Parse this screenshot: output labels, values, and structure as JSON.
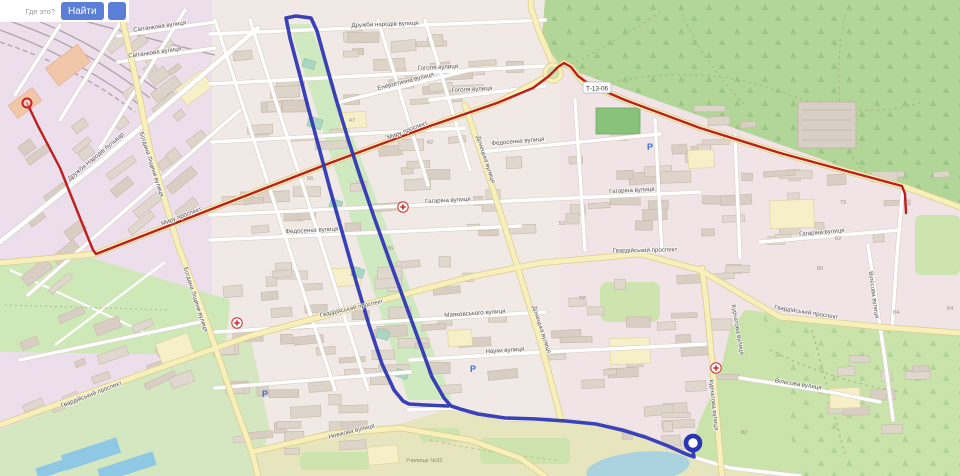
{
  "ui": {
    "search_placeholder": "Где это?",
    "find_label": "Найти",
    "accent_color": "#5b7ed7"
  },
  "map": {
    "shield_label": "Т-13-06",
    "colors": {
      "route_red": "#bc1f1f",
      "route_blue": "#2b34b3",
      "forest": "#b2d698",
      "water": "#aad3df",
      "road_yellow": "#f8f0ba"
    },
    "street_labels": [
      {
        "t": "Світанкова вулиця",
        "x": 160,
        "y": 28,
        "r": -8
      },
      {
        "t": "Світанкова вулиця",
        "x": 155,
        "y": 54,
        "r": -8
      },
      {
        "t": "Дружби народів вулиця",
        "x": 385,
        "y": 26,
        "r": -2
      },
      {
        "t": "Гоголя вулиця",
        "x": 438,
        "y": 69,
        "r": -3
      },
      {
        "t": "Гоголя вулиця",
        "x": 472,
        "y": 91,
        "r": -3
      },
      {
        "t": "Енергетична вулиця",
        "x": 406,
        "y": 83,
        "r": -14
      },
      {
        "t": "Дружби Народів бульвар",
        "x": 97,
        "y": 158,
        "r": -40
      },
      {
        "t": "Богдана Ліщини вулиця",
        "x": 150,
        "y": 165,
        "r": 72
      },
      {
        "t": "Богдана Ліщини вулиця",
        "x": 194,
        "y": 300,
        "r": 72
      },
      {
        "t": "Миру проспект",
        "x": 182,
        "y": 218,
        "r": -21
      },
      {
        "t": "Миру проспект",
        "x": 408,
        "y": 132,
        "r": -21
      },
      {
        "t": "Гагаріна вулиця",
        "x": 448,
        "y": 202,
        "r": -3
      },
      {
        "t": "Гагаріна вулиця",
        "x": 632,
        "y": 192,
        "r": -3
      },
      {
        "t": "Гагаріна вулиця",
        "x": 822,
        "y": 234,
        "r": -5
      },
      {
        "t": "Федосенка вулиця",
        "x": 312,
        "y": 232,
        "r": -3
      },
      {
        "t": "Федосенка вулиця",
        "x": 518,
        "y": 143,
        "r": -5
      },
      {
        "t": "Донецька вулиця",
        "x": 484,
        "y": 160,
        "r": 72
      },
      {
        "t": "Донецька вулиця",
        "x": 540,
        "y": 330,
        "r": 72
      },
      {
        "t": "Гвардійський проспект",
        "x": 645,
        "y": 252,
        "r": -1
      },
      {
        "t": "Гвардійський проспект",
        "x": 806,
        "y": 314,
        "r": 9
      },
      {
        "t": "Гвардійський проспект",
        "x": 92,
        "y": 396,
        "r": -21
      },
      {
        "t": "Гвардійський проспект",
        "x": 352,
        "y": 310,
        "r": -13
      },
      {
        "t": "Науки вулиця",
        "x": 505,
        "y": 352,
        "r": -4
      },
      {
        "t": "Маяковського вулиця",
        "x": 475,
        "y": 315,
        "r": -4
      },
      {
        "t": "Курчатова вулиця",
        "x": 712,
        "y": 405,
        "r": 84
      },
      {
        "t": "Курчатова вулиця",
        "x": 736,
        "y": 330,
        "r": 80
      },
      {
        "t": "Вілєсова вулиця",
        "x": 872,
        "y": 295,
        "r": 82
      },
      {
        "t": "Вілєсова вулиця",
        "x": 798,
        "y": 386,
        "r": 9
      },
      {
        "t": "Новікова вулиця",
        "x": 352,
        "y": 433,
        "r": -14
      }
    ],
    "house_numbers": [
      {
        "t": "47",
        "x": 352,
        "y": 122
      },
      {
        "t": "42",
        "x": 430,
        "y": 144
      },
      {
        "t": "36",
        "x": 390,
        "y": 250
      },
      {
        "t": "52",
        "x": 562,
        "y": 225
      },
      {
        "t": "62",
        "x": 838,
        "y": 240
      },
      {
        "t": "77",
        "x": 582,
        "y": 300
      },
      {
        "t": "80",
        "x": 820,
        "y": 270
      },
      {
        "t": "84",
        "x": 896,
        "y": 314
      },
      {
        "t": "79",
        "x": 843,
        "y": 204
      },
      {
        "t": "82",
        "x": 744,
        "y": 434
      },
      {
        "t": "64",
        "x": 950,
        "y": 310
      },
      {
        "t": "56",
        "x": 310,
        "y": 180
      }
    ],
    "area_labels": [
      {
        "t": "Училище №32",
        "x": 424,
        "y": 462
      }
    ],
    "pois": {
      "medical": [
        [
          403,
          207
        ],
        [
          237,
          323
        ],
        [
          716,
          368
        ]
      ],
      "parking": [
        [
          650,
          150
        ],
        [
          473,
          372
        ],
        [
          265,
          397
        ]
      ]
    },
    "routes": {
      "red": {
        "path": "M27,103 L38,126 L60,168 L80,218 L93,250 L96,254 L150,233 L240,198 L330,163 L430,126 L497,103 L533,88 L549,76 L558,67 L564,63 L571,67 L578,76 L590,85 L625,100 L700,128 L780,153 L850,172 L902,186 L905,194 L906,213",
        "start": [
          27,
          103
        ],
        "end": [
          906,
          213
        ]
      },
      "blue": {
        "path": "M693,451 L694,457 L686,454 L668,446 L645,437 L622,430 L596,424 L566,421 L536,419 L505,418 L478,414 L460,409 L451,406 L444,398 L432,377 L419,341 L404,300 L389,259 L374,217 L360,176 L348,139 L336,99 L325,60 L317,31 L311,18 L296,16 L286,18 L290,38 L299,72 L308,107 L318,144 L330,189 L343,235 L356,281 L369,325 L382,364 L394,390 L403,401 L409,404 L425,405 L448,406",
        "end": [
          693,
          443
        ]
      }
    }
  }
}
